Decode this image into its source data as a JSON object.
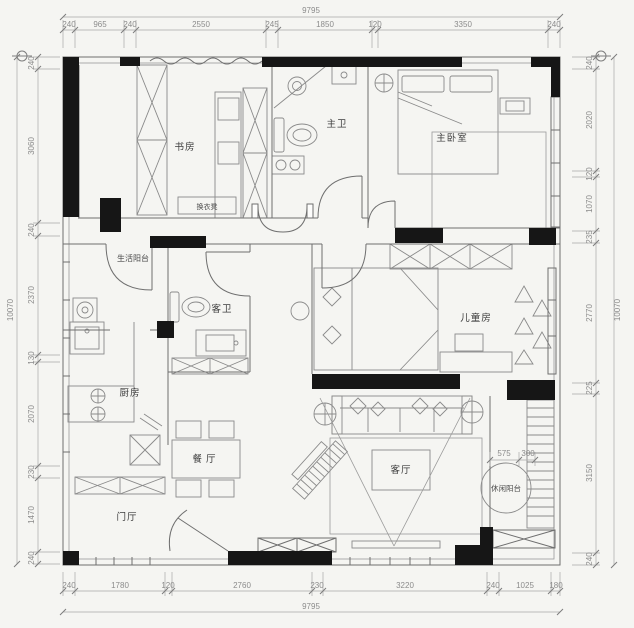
{
  "colors": {
    "paper": "#f5f5f2",
    "plan_fill": "#fdfdfc",
    "wall": "#161616",
    "line": "#6f6f6f",
    "dim_text": "#8b8b8b",
    "room_text": "#3d3d3d"
  },
  "rooms": {
    "study": "书房",
    "master_bath": "主卫",
    "master_bedroom": "主卧室",
    "dressing_bench": "换衣凳",
    "service_balcony": "生活阳台",
    "guest_bath": "客卫",
    "kids_room": "儿童房",
    "kitchen": "厨房",
    "dining": "餐厅",
    "living": "客厅",
    "foyer": "门厅",
    "leisure_balcony": "休闲阳台"
  },
  "dims": {
    "top": {
      "total": "9795",
      "segments": [
        "240",
        "965",
        "240",
        "2550",
        "245",
        "1850",
        "120",
        "3350",
        "240"
      ]
    },
    "bottom": {
      "total": "9795",
      "segments": [
        "240",
        "1780",
        "120",
        "2760",
        "230",
        "3220",
        "240",
        "1025",
        "180"
      ]
    },
    "left": {
      "total": "10070",
      "segments": [
        "240",
        "3060",
        "240",
        "2370",
        "130",
        "2070",
        "230",
        "1470",
        "240"
      ]
    },
    "right": {
      "total": "10070",
      "segments": [
        "240",
        "2020",
        "120",
        "1070",
        "235",
        "2770",
        "225",
        "3150",
        "240"
      ]
    },
    "inner": {
      "w": "575",
      "d": "300"
    }
  }
}
